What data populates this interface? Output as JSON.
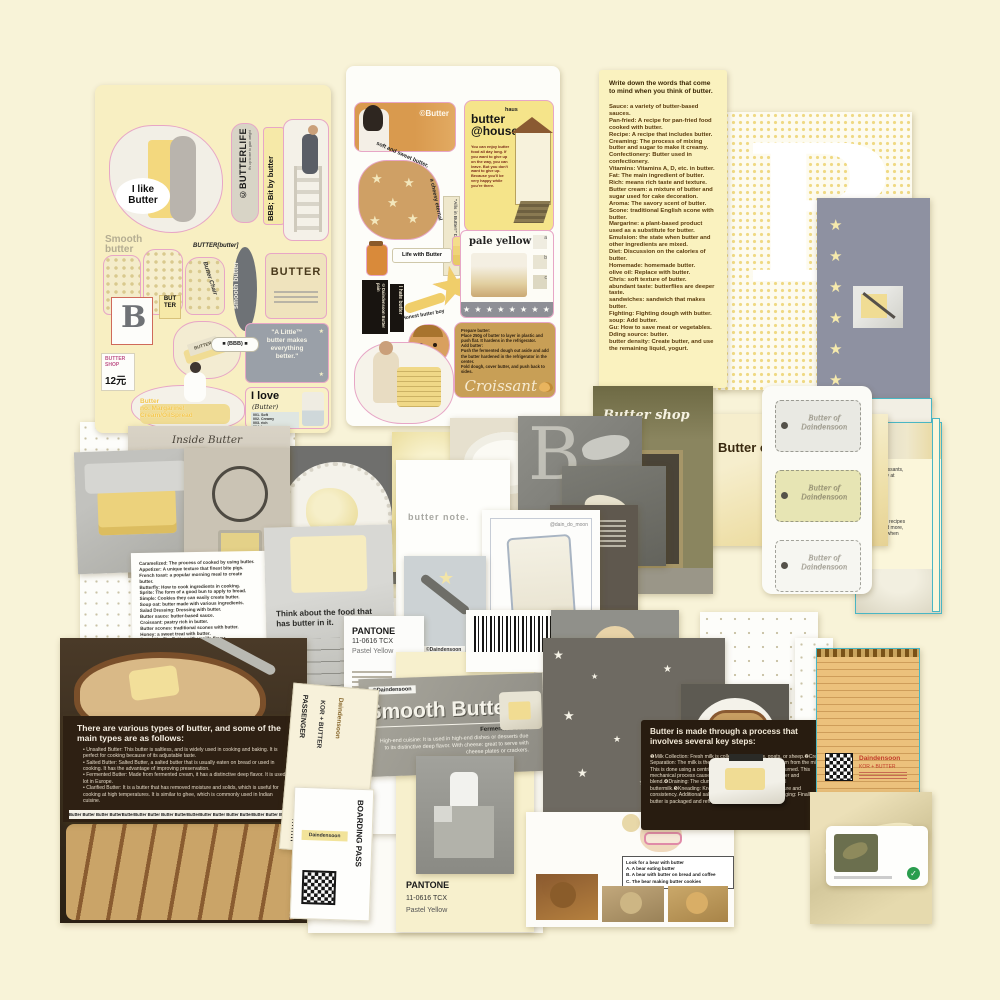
{
  "palette": {
    "background": "#f8f3d8",
    "sheet_yellow": "#f8efc2",
    "card_yellow": "#faf2bf",
    "slate_gray": "#8e91a1",
    "dark_brown": "#2e2013",
    "butter_yellow": "#f0dc94",
    "accent_cyan": "#49b6c4",
    "accent_pink": "#e7a6c6",
    "accent_red": "#c23b2a",
    "accent_green": "#2a9d4e"
  },
  "glyphs": {
    "star": "★",
    "check": "✓",
    "letter_b": "B"
  },
  "sheet1": {
    "like_label": "I like\nButter",
    "butterlife": "©BUTTERLIFE",
    "butterlife_sub": "It's up to me to gain weight",
    "bbb_vertical": "BBB; Bit by butter",
    "smooth_butter": "Smooth\nbutter",
    "butter_butter": "BUTTER[butter]",
    "butter_chair": "Butter Chair",
    "smooth_oval": "smooth butter",
    "pack_label": "BUTTER",
    "butter_stamp": "BUT\nTER",
    "shop_tag": "BUTTER\nSHOP",
    "shop_price": "12元",
    "bbb_pill": "■ (BBB) ■",
    "woman_caption": "Butter\nno. Margarine!\nCream/OilSpread",
    "quote": "\"A Little™\nbutter makes\neverything\nbetter.\"",
    "love_title": "I love",
    "love_sub": "(Butter)",
    "love_list": "001.   Soft\n002.   Creamy\n003.   rich\n004.   heavy\n005.   sweet",
    "sticks_label": "BUTTER"
  },
  "sheet2": {
    "credit": "©Butter",
    "haus": "haus",
    "house_title": "butter\n@house",
    "house_body": "You can enjoy butter food all day long. If you want to give up on the way, you can leave. But you don't want to give up. Because you'll be very happy while you're there.",
    "toast_arc_1": "soft and sweet butter,",
    "toast_arc_2": "a cheesy eternal",
    "side_strip": "\"Alls in Butter!\" Daindensoon",
    "life_with": "Life with Butter",
    "black_tag": "©Daindensoon Butter pain",
    "hate_tag": "I hate butter",
    "star_label": "Butter Star",
    "boy_label": "Honest butter boy",
    "pale_title": "pale yellow",
    "pale_a": "a",
    "pale_b": "b",
    "pale_c": "c",
    "pale_stars": "★ ★ ★ ★ ★ ★ ★ ★",
    "croissant_body": "Prepare butter:\nPlace 250g of butter to layer in plastic and push flat. It hardens in the refrigerator.\nAdd butter:\nPush the fermented dough out aside and add the butter hardened in the refrigerator in the center.\nFold dough, cover butter, and push back to sides.",
    "croissant_title": "Croissant"
  },
  "word_card": {
    "intro": "Write down the words that come to mind when you think of butter.",
    "body": "Sauce: a variety of butter-based sauces.\nPan-fried: A recipe for pan-fried food cooked with butter.\nRecipe: A recipe that includes butter.\nCreaming: The process of mixing butter and sugar to make it creamy.\nConfectionery: Butter used in confectionery.\nVitamins: Vitamins A, D, etc. in butter.\nFat: The main ingredient of butter.\nRich: means rich taste and texture.\nButter cream: a mixture of butter and sugar used for cake decoration.\nAroma: The savory scent of butter.\nScone: traditional English scone with butter.\nMargarine: a plant-based product used as a substitute for butter.\nEmulsion: the state when butter and other ingredients are mixed.\nDiet: Discussion on the calories of butter.\nHomemade: homemade butter.\nolive oil: Replace with butter.\nChris: soft texture of butter.\nabundant taste: butterflies are deeper taste.\nsandwiches: sandwich that makes butter.\nFighting: Fighting dough with butter.\nsoup: Add butter.\nGu: How to save meat or vegetables.\nDding source: butter.\nbutter density: Create butter, and use the remaining liquid, yogurt."
  },
  "right_column": {
    "stars_column": "★\n★\n★\n★\n★\n★",
    "note_fragment_1": "used in croissants,\nsimple to try at",
    "note_fragment_2": "ty of baking recipes\nmuffins, and more,\nd the taste when"
  },
  "tags_card": {
    "label": "Butter of\nDaindensoon"
  },
  "shop": {
    "sign": "Butter shop"
  },
  "butter_of": {
    "title": "Butter of B"
  },
  "toast_card": {
    "caption": "Butter."
  },
  "center": {
    "butter_note": "butter note.",
    "glass_handle": "@dain_do_moon",
    "think_text": "Think about the food that\nhas butter in it.",
    "knife_tag": "©Daindensoon"
  },
  "inside_card": {
    "title": "Inside Butter",
    "notes": "Caramelized: The process of cooked by using butter.\nAppetizer: A unique texture that finest bite pigs.\nFrench toast: a popular morning meal to create butter.\nButterfly: How to cook ingredients in cooking.\nSprite: The form of a good bun to apply to bread.\nSimple: Cookies they can easily create butter.\nSoup oat: butter made with various ingredients.\nSalad Dressing: Dressing with butter.\nButter sauce: butter-based sauce.\nCroissant: pastry rich in butter.\nButter scones: traditional scones with butter.\nHoney: a sweet treat with butter.\nButtel Vanilla: Butter with vanilla flavor.\nAnimal: butter used in desert dishes.\nButter Egg: a dish of butter and egg mixed together.\nButter pudding: pudding dessert with butter.\nButtel popcorn: buttery popcorn.\nButter Milk Pancakes: Pancakes with butter and milk.\nButter Cookies: Cookies with butter as the main ingredient.\nButter rum: Butter drink mixed with rum.\nButtel tea: a tea drink with butter."
  },
  "pantone": {
    "brand": "PANTONE",
    "code": "11-0616 TCX",
    "name": "Pastel Yellow"
  },
  "barcode": {
    "number": "9809211001005"
  },
  "smooth_card": {
    "tag": "©Daindensoon",
    "title": "Smooth Butter",
    "subtitle": "Fermented Butter",
    "body": "High-end cuisine: It is used in high-end dishes or desserts due to its distinctive deep flavor. With cheese: great to serve with cheese plates or crackers."
  },
  "process_box": {
    "title": "Butter is made through a process that involves several key steps:",
    "body": "❶Milk Collection: Fresh milk is collected from cows, goats, or sheep.❷Cream Separation: The milk is then processed to separate the cream from the milk. This is done using a centrifuge.❸Churning: The cream is churned. This mechanical process causes the fat globules to clump together and blend.❹Draining: The clumped fat is then drained of residual buttermilk.❺Kneading: Kneaded to achieve the desired texture and consistency. Additional salt may be added for flavor.❻Packaging: Finally, the butter is packaged and refrigerated to maintain freshness."
  },
  "types_box": {
    "title": "There are various types of butter, and some of the main types are as follows:",
    "body": "•  Unsalted Butter: This butter is saltless, and is widely used in cooking and baking. It is perfect for cooking because of its adjustable taste.\n•  Salted Butter: Salted Butter, a salted butter that is usually eaten on bread or used in cooking. It has the advantage of improving preservation.\n•  Fermented Butter: Made from fermented cream, it has a distinctive deep flavor. It is used a lot in Europe.\n•  Clarified Butter: It is a butter that has removed moisture and solids, which is useful for cooking at high temperatures. It is similar to ghee, which is commonly used in Indian cuisine.",
    "footer": "Butter  Butter      Butter  ButterButterButter  Butter  Butter      ButterButterButter  Butter  Butter      ButterButter  Butter  Butter"
  },
  "tickets": {
    "passenger": "PASSENGER",
    "route": "KOR + BUTTER",
    "brand": "Daindensoon",
    "boarding": "BOARDING PASS"
  },
  "notepad": {
    "brand": "Daindensoon",
    "route": "KOR + BUTTER"
  },
  "bear_card": {
    "prompt": "Look for a bear with butter\nA.   A bear eating butter\nB.   A bear with butter on bread and coffee\nC.   The bear making butter cookies"
  }
}
